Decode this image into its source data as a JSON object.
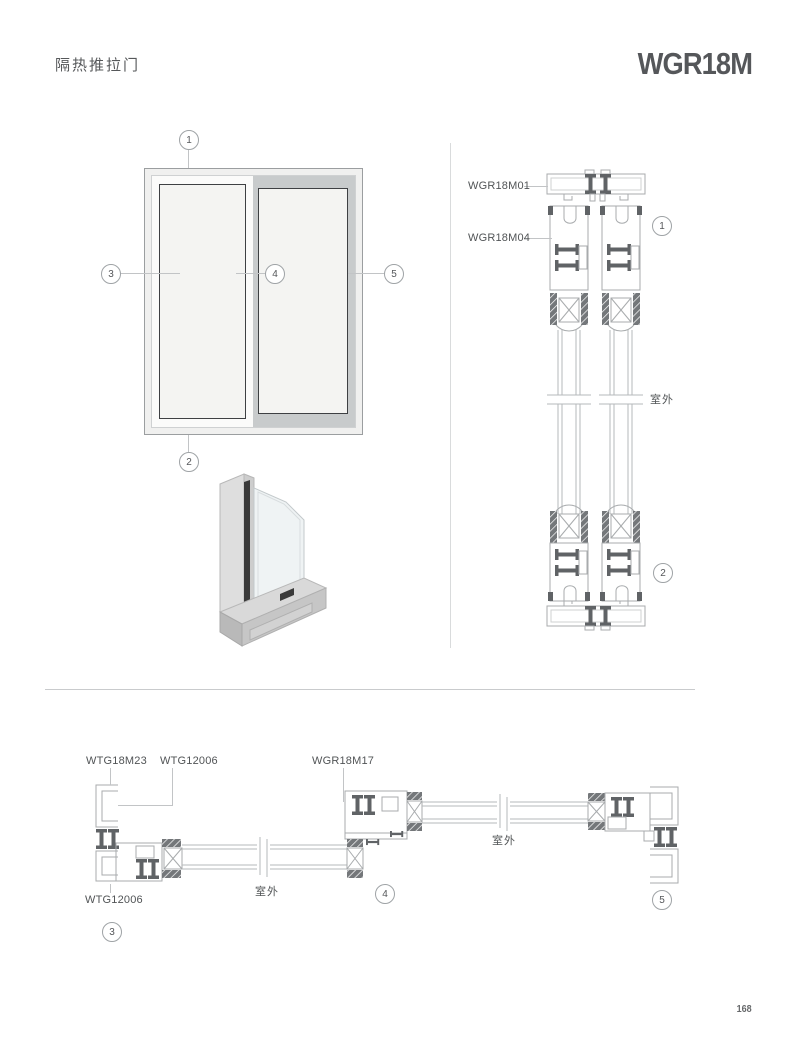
{
  "header": {
    "category": "隔热推拉门",
    "model": "WGR18M"
  },
  "elevation": {
    "callouts": [
      "1",
      "2",
      "3",
      "4",
      "5"
    ]
  },
  "vertical_section": {
    "part_labels": [
      "WGR18M01",
      "WGR18M04"
    ],
    "callouts": [
      "1",
      "2"
    ],
    "outdoor": "室外"
  },
  "horizontal_section": {
    "part_labels": [
      "WTG18M23",
      "WTG12006",
      "WGR18M17",
      "WTG12006"
    ],
    "callouts": [
      "3",
      "4",
      "5"
    ],
    "outdoor_left": "室外",
    "outdoor_right": "室外"
  },
  "footer": {
    "page_number": "168"
  },
  "colors": {
    "accent": "#55575a",
    "line_art": "#a8abad",
    "dark_detail": "#606366",
    "panel_border": "#3e4043"
  }
}
